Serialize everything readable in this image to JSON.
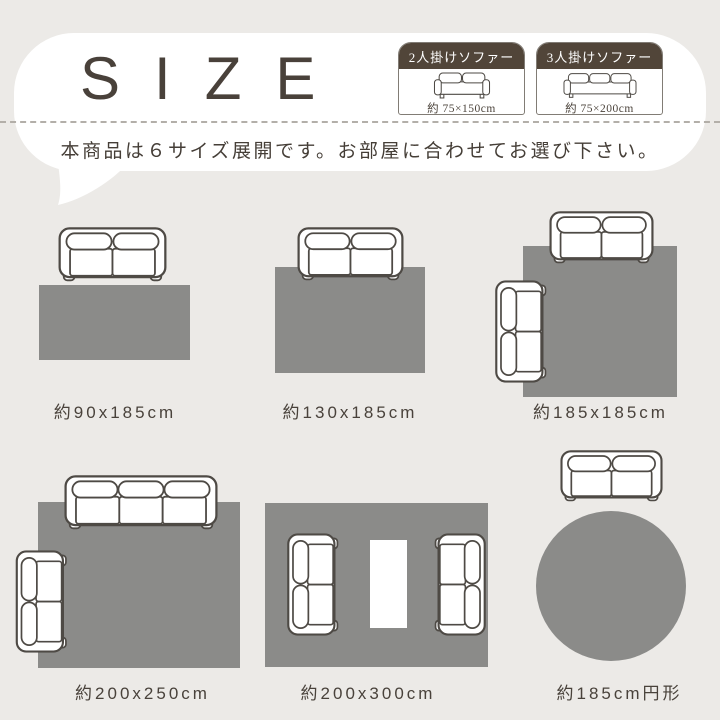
{
  "title": "SIZE",
  "subtitle": "本商品は６サイズ展開です。お部屋に合わせてお選び下さい。",
  "legend": {
    "items": [
      {
        "label": "2人掛けソファー",
        "size": "約 75×150cm",
        "icon": "2-seater-sofa-front-icon"
      },
      {
        "label": "3人掛けソファー",
        "size": "約 75×200cm",
        "icon": "3-seater-sofa-front-icon"
      }
    ]
  },
  "diagrams": [
    {
      "label": "約90x185cm",
      "rug_shape": "rectangle",
      "sofas": [
        "2-seater-top"
      ]
    },
    {
      "label": "約130x185cm",
      "rug_shape": "rectangle",
      "sofas": [
        "2-seater-top"
      ]
    },
    {
      "label": "約185x185cm",
      "rug_shape": "square",
      "sofas": [
        "2-seater-top",
        "2-seater-left-side"
      ]
    },
    {
      "label": "約200x250cm",
      "rug_shape": "rectangle",
      "sofas": [
        "3-seater-top",
        "2-seater-left-side"
      ]
    },
    {
      "label": "約200x300cm",
      "rug_shape": "rectangle",
      "sofas": [
        "2-seater-facing-right",
        "2-seater-facing-left"
      ],
      "table": true
    },
    {
      "label": "約185cm円形",
      "rug_shape": "circle",
      "sofas": [
        "2-seater-top"
      ]
    }
  ],
  "colors": {
    "background": "#eceae7",
    "bubble": "#ffffff",
    "rug": "#8b8b89",
    "legend_header": "#514539",
    "text": "#49423b",
    "sofa_outline": "#4e4a45",
    "dashed_line": "#b3afa9"
  }
}
